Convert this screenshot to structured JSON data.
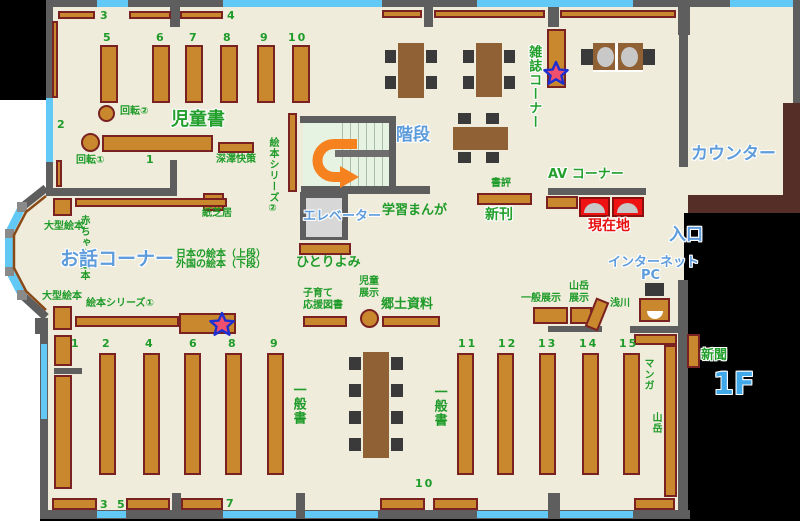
{
  "floor_label": "1F",
  "titles": {
    "jidosho": "児童書",
    "ohanashi": "お話コーナー",
    "kaidan": "階段",
    "counter": "カウンター",
    "elevator": "エレベーター",
    "zasshi": "雑誌コーナー",
    "av": "AV コーナー",
    "genzaichi": "現在地",
    "iriguchi": "入口",
    "internet": "インターネット",
    "pc": "PC",
    "shinkan": "新刊",
    "shinbun": "新聞"
  },
  "colors": {
    "floor": "#efecdc",
    "wall": "#5e5e5e",
    "window": "#62c8f6",
    "shelf": "#c9882e",
    "shelf_border": "#7a2121",
    "table": "#8f6134",
    "chair": "#3a3a3a",
    "counter": "#552e28",
    "stairs": "#e6f2e2",
    "highlight_red": "#ee1212",
    "text_green": "#1e9b28",
    "text_blue": "#5e9cdb",
    "arrow_orange": "#f5821f",
    "outside": "#000000"
  },
  "labels": [
    {
      "t": "回転②",
      "x": 120,
      "y": 106
    },
    {
      "t": "回転①",
      "x": 76,
      "y": 155
    },
    {
      "t": "深澤快策",
      "x": 216,
      "y": 154
    },
    {
      "t": "紙芝居",
      "x": 202,
      "y": 208
    },
    {
      "t": "大型絵本",
      "x": 44,
      "y": 221
    },
    {
      "t": "大型絵本",
      "x": 42,
      "y": 291
    },
    {
      "t": "絵本シリーズ①",
      "x": 86,
      "y": 298
    },
    {
      "t": "日本の絵本（上段）",
      "x": 176,
      "y": 249
    },
    {
      "t": "外国の絵本（下段）",
      "x": 176,
      "y": 259
    },
    {
      "t": "ひとりよみ",
      "x": 296,
      "y": 255,
      "cls": "g13"
    },
    {
      "t": "子育て\n応援図書",
      "x": 303,
      "y": 288
    },
    {
      "t": "児童\n展示",
      "x": 359,
      "y": 276
    },
    {
      "t": "郷土資料",
      "x": 381,
      "y": 297,
      "cls": "g13"
    },
    {
      "t": "一般展示",
      "x": 521,
      "y": 293
    },
    {
      "t": "山岳\n展示",
      "x": 569,
      "y": 281
    },
    {
      "t": "浅川",
      "x": 610,
      "y": 298
    },
    {
      "t": "書評",
      "x": 491,
      "y": 178
    },
    {
      "t": "学習まんが",
      "x": 382,
      "y": 203,
      "cls": "g13"
    },
    {
      "t": "赤ちゃん絵本",
      "x": 77,
      "y": 215,
      "cls": "v"
    },
    {
      "t": "絵本シリーズ②",
      "x": 266,
      "y": 137,
      "cls": "v"
    },
    {
      "t": "一般書",
      "x": 290,
      "y": 383,
      "cls": "v g13"
    },
    {
      "t": "一般書",
      "x": 431,
      "y": 385,
      "cls": "v g13"
    },
    {
      "t": "マンガ",
      "x": 641,
      "y": 358,
      "cls": "v"
    },
    {
      "t": "山岳",
      "x": 649,
      "y": 412,
      "cls": "v"
    }
  ],
  "numbers": [
    {
      "t": "3",
      "x": 100,
      "y": 9
    },
    {
      "t": "4",
      "x": 227,
      "y": 9
    },
    {
      "t": "5",
      "x": 103,
      "y": 31
    },
    {
      "t": "6",
      "x": 156,
      "y": 31
    },
    {
      "t": "7",
      "x": 189,
      "y": 31
    },
    {
      "t": "8",
      "x": 223,
      "y": 31
    },
    {
      "t": "9",
      "x": 260,
      "y": 31
    },
    {
      "t": "10",
      "x": 288,
      "y": 31
    },
    {
      "t": "2",
      "x": 57,
      "y": 118
    },
    {
      "t": "1",
      "x": 146,
      "y": 153
    },
    {
      "t": "1",
      "x": 71,
      "y": 337
    },
    {
      "t": "2",
      "x": 102,
      "y": 337
    },
    {
      "t": "4",
      "x": 145,
      "y": 337
    },
    {
      "t": "6",
      "x": 189,
      "y": 337
    },
    {
      "t": "8",
      "x": 228,
      "y": 337
    },
    {
      "t": "9",
      "x": 270,
      "y": 337
    },
    {
      "t": "11",
      "x": 458,
      "y": 337
    },
    {
      "t": "12",
      "x": 498,
      "y": 337
    },
    {
      "t": "13",
      "x": 538,
      "y": 337
    },
    {
      "t": "14",
      "x": 579,
      "y": 337
    },
    {
      "t": "15",
      "x": 619,
      "y": 337
    },
    {
      "t": "3",
      "x": 100,
      "y": 498
    },
    {
      "t": "5",
      "x": 117,
      "y": 498
    },
    {
      "t": "7",
      "x": 226,
      "y": 497
    },
    {
      "t": "10",
      "x": 415,
      "y": 477
    }
  ],
  "geometry": [
    {
      "name": "floor-area",
      "cls": "floor",
      "items": [
        [
          46,
          0,
          644,
          519
        ],
        [
          690,
          0,
          110,
          213
        ]
      ]
    },
    {
      "name": "outside-black",
      "cls": "black",
      "items": [
        [
          0,
          0,
          46,
          100
        ],
        [
          684,
          213,
          116,
          308
        ],
        [
          40,
          519,
          760,
          2
        ]
      ]
    },
    {
      "name": "stairwell-floor",
      "cls": "stairs",
      "items": [
        [
          303,
          123,
          86,
          67
        ]
      ]
    },
    {
      "name": "stair-steps",
      "cls": "steps",
      "items": [
        [
          335,
          123,
          54,
          27
        ],
        [
          335,
          157,
          54,
          33
        ]
      ]
    },
    {
      "name": "stair-landing",
      "cls": "landing",
      "items": [
        [
          335,
          150,
          54,
          7
        ]
      ]
    },
    {
      "name": "elevator-shaft",
      "cls": "wall",
      "items": [
        [
          300,
          192,
          48,
          48
        ]
      ]
    },
    {
      "name": "elevator-car",
      "cls": "elevin",
      "items": [
        [
          306,
          198,
          36,
          39
        ]
      ]
    },
    {
      "name": "counter-desk",
      "cls": "counterc",
      "items": [
        [
          783,
          103,
          17,
          110
        ],
        [
          688,
          195,
          112,
          18
        ]
      ]
    },
    {
      "name": "wall-segment",
      "cls": "wall",
      "items": [
        [
          46,
          0,
          51,
          7
        ],
        [
          128,
          0,
          95,
          7
        ],
        [
          382,
          0,
          95,
          7
        ],
        [
          633,
          0,
          97,
          7
        ],
        [
          793,
          0,
          7,
          7
        ],
        [
          170,
          0,
          10,
          27
        ],
        [
          424,
          0,
          9,
          27
        ],
        [
          548,
          0,
          11,
          27
        ],
        [
          678,
          0,
          12,
          35
        ],
        [
          46,
          7,
          7,
          91
        ],
        [
          46,
          162,
          7,
          27
        ],
        [
          793,
          7,
          7,
          96
        ],
        [
          679,
          35,
          9,
          132
        ],
        [
          45,
          188,
          132,
          8
        ],
        [
          170,
          160,
          7,
          28
        ],
        [
          300,
          116,
          96,
          7
        ],
        [
          389,
          123,
          7,
          67
        ],
        [
          301,
          186,
          129,
          8
        ],
        [
          548,
          188,
          98,
          7
        ],
        [
          548,
          326,
          54,
          6
        ],
        [
          630,
          326,
          48,
          7
        ],
        [
          678,
          280,
          10,
          233
        ],
        [
          35,
          318,
          13,
          16
        ],
        [
          40,
          333,
          8,
          186
        ],
        [
          40,
          510,
          650,
          9
        ],
        [
          172,
          493,
          9,
          18
        ],
        [
          296,
          493,
          9,
          18
        ],
        [
          548,
          493,
          12,
          18
        ],
        [
          54,
          368,
          28,
          6
        ]
      ]
    },
    {
      "name": "window",
      "cls": "win",
      "items": [
        [
          97,
          0,
          31,
          7
        ],
        [
          223,
          0,
          159,
          7
        ],
        [
          477,
          0,
          156,
          7
        ],
        [
          730,
          0,
          63,
          7
        ],
        [
          46,
          98,
          7,
          64
        ],
        [
          41,
          344,
          6,
          75
        ],
        [
          97,
          511,
          29,
          7
        ],
        [
          223,
          511,
          73,
          7
        ],
        [
          305,
          511,
          73,
          7
        ],
        [
          477,
          511,
          71,
          7
        ],
        [
          560,
          511,
          73,
          7
        ]
      ]
    },
    {
      "name": "bookshelf",
      "cls": "shelf",
      "items": [
        [
          58,
          11,
          37,
          8
        ],
        [
          129,
          11,
          42,
          8
        ],
        [
          180,
          11,
          43,
          8
        ],
        [
          382,
          10,
          40,
          8
        ],
        [
          434,
          10,
          111,
          8
        ],
        [
          560,
          10,
          116,
          8
        ],
        [
          100,
          45,
          18,
          58
        ],
        [
          152,
          45,
          18,
          58
        ],
        [
          185,
          45,
          18,
          58
        ],
        [
          220,
          45,
          18,
          58
        ],
        [
          257,
          45,
          18,
          58
        ],
        [
          292,
          45,
          18,
          58
        ],
        [
          52,
          21,
          6,
          77
        ],
        [
          56,
          160,
          6,
          27
        ],
        [
          102,
          135,
          111,
          17
        ],
        [
          218,
          142,
          36,
          11
        ],
        [
          288,
          113,
          9,
          79
        ],
        [
          203,
          193,
          21,
          18
        ],
        [
          75,
          198,
          152,
          9
        ],
        [
          53,
          198,
          19,
          18
        ],
        [
          53,
          306,
          19,
          24
        ],
        [
          299,
          243,
          52,
          12
        ],
        [
          75,
          316,
          104,
          11
        ],
        [
          179,
          313,
          57,
          21
        ],
        [
          547,
          29,
          19,
          59
        ],
        [
          477,
          193,
          55,
          12
        ],
        [
          546,
          196,
          32,
          13
        ],
        [
          303,
          316,
          44,
          11
        ],
        [
          382,
          316,
          58,
          11
        ],
        [
          533,
          307,
          35,
          17
        ],
        [
          570,
          307,
          22,
          17
        ],
        [
          590,
          299,
          14,
          31,
          22
        ],
        [
          639,
          298,
          31,
          24
        ],
        [
          54,
          335,
          18,
          31
        ],
        [
          54,
          375,
          18,
          114
        ],
        [
          99,
          353,
          17,
          122
        ],
        [
          143,
          353,
          17,
          122
        ],
        [
          184,
          353,
          17,
          122
        ],
        [
          225,
          353,
          17,
          122
        ],
        [
          267,
          353,
          17,
          122
        ],
        [
          457,
          353,
          17,
          122
        ],
        [
          497,
          353,
          17,
          122
        ],
        [
          539,
          353,
          17,
          122
        ],
        [
          582,
          353,
          17,
          122
        ],
        [
          623,
          353,
          17,
          122
        ],
        [
          52,
          498,
          45,
          12
        ],
        [
          126,
          498,
          44,
          12
        ],
        [
          181,
          498,
          42,
          12
        ],
        [
          380,
          498,
          45,
          12
        ],
        [
          433,
          498,
          45,
          12
        ],
        [
          634,
          498,
          41,
          12
        ],
        [
          634,
          334,
          43,
          11
        ],
        [
          664,
          345,
          13,
          152
        ]
      ]
    },
    {
      "name": "newspaper-rack",
      "cls": "shelf",
      "items": [
        [
          687,
          334,
          13,
          34
        ]
      ]
    },
    {
      "name": "rotating-rack",
      "cls": "shelf circ",
      "items": [
        [
          98,
          105,
          17,
          17
        ],
        [
          81,
          133,
          19,
          19
        ],
        [
          360,
          309,
          19,
          19
        ]
      ]
    },
    {
      "name": "reading-table",
      "cls": "table",
      "items": [
        [
          398,
          43,
          26,
          55
        ],
        [
          476,
          43,
          26,
          54
        ],
        [
          453,
          127,
          55,
          23
        ],
        [
          363,
          352,
          26,
          106
        ],
        [
          593,
          43,
          50,
          28
        ]
      ]
    },
    {
      "name": "chair",
      "cls": "chair",
      "items": [
        [
          385,
          50,
          11,
          13
        ],
        [
          385,
          76,
          11,
          13
        ],
        [
          426,
          50,
          11,
          13
        ],
        [
          426,
          76,
          11,
          13
        ],
        [
          463,
          50,
          11,
          13
        ],
        [
          463,
          76,
          11,
          13
        ],
        [
          504,
          50,
          11,
          13
        ],
        [
          504,
          76,
          11,
          13
        ],
        [
          458,
          113,
          13,
          11
        ],
        [
          486,
          113,
          13,
          11
        ],
        [
          458,
          152,
          13,
          11
        ],
        [
          486,
          152,
          13,
          11
        ],
        [
          349,
          357,
          12,
          13
        ],
        [
          349,
          384,
          12,
          13
        ],
        [
          349,
          411,
          12,
          13
        ],
        [
          349,
          438,
          12,
          13
        ],
        [
          391,
          357,
          12,
          13
        ],
        [
          391,
          384,
          12,
          13
        ],
        [
          391,
          411,
          12,
          13
        ],
        [
          391,
          438,
          12,
          13
        ],
        [
          645,
          283,
          19,
          13
        ]
      ]
    },
    {
      "name": "sofa-armrest",
      "cls": "chair",
      "items": [
        [
          581,
          49,
          12,
          16
        ],
        [
          643,
          49,
          12,
          16
        ]
      ]
    },
    {
      "name": "sofa-cushion",
      "cls": "cush",
      "items": [
        [
          597,
          47,
          17,
          20
        ],
        [
          621,
          47,
          17,
          20
        ]
      ]
    },
    {
      "name": "sofa-divider",
      "cls": "whiteline",
      "items": [
        [
          615,
          43,
          3,
          28
        ],
        [
          593,
          70,
          50,
          2
        ]
      ]
    },
    {
      "name": "highlight-sofa",
      "cls": "redsofa",
      "items": [
        [
          579,
          197,
          31,
          20
        ],
        [
          612,
          197,
          32,
          20
        ]
      ]
    },
    {
      "name": "highlight-sofa-cushion",
      "cls": "dome",
      "items": [
        [
          584,
          203,
          21,
          10
        ],
        [
          617,
          203,
          21,
          10
        ]
      ]
    },
    {
      "name": "pc-desk-inset",
      "cls": "domew",
      "items": [
        [
          647,
          311,
          16,
          8
        ]
      ]
    }
  ]
}
